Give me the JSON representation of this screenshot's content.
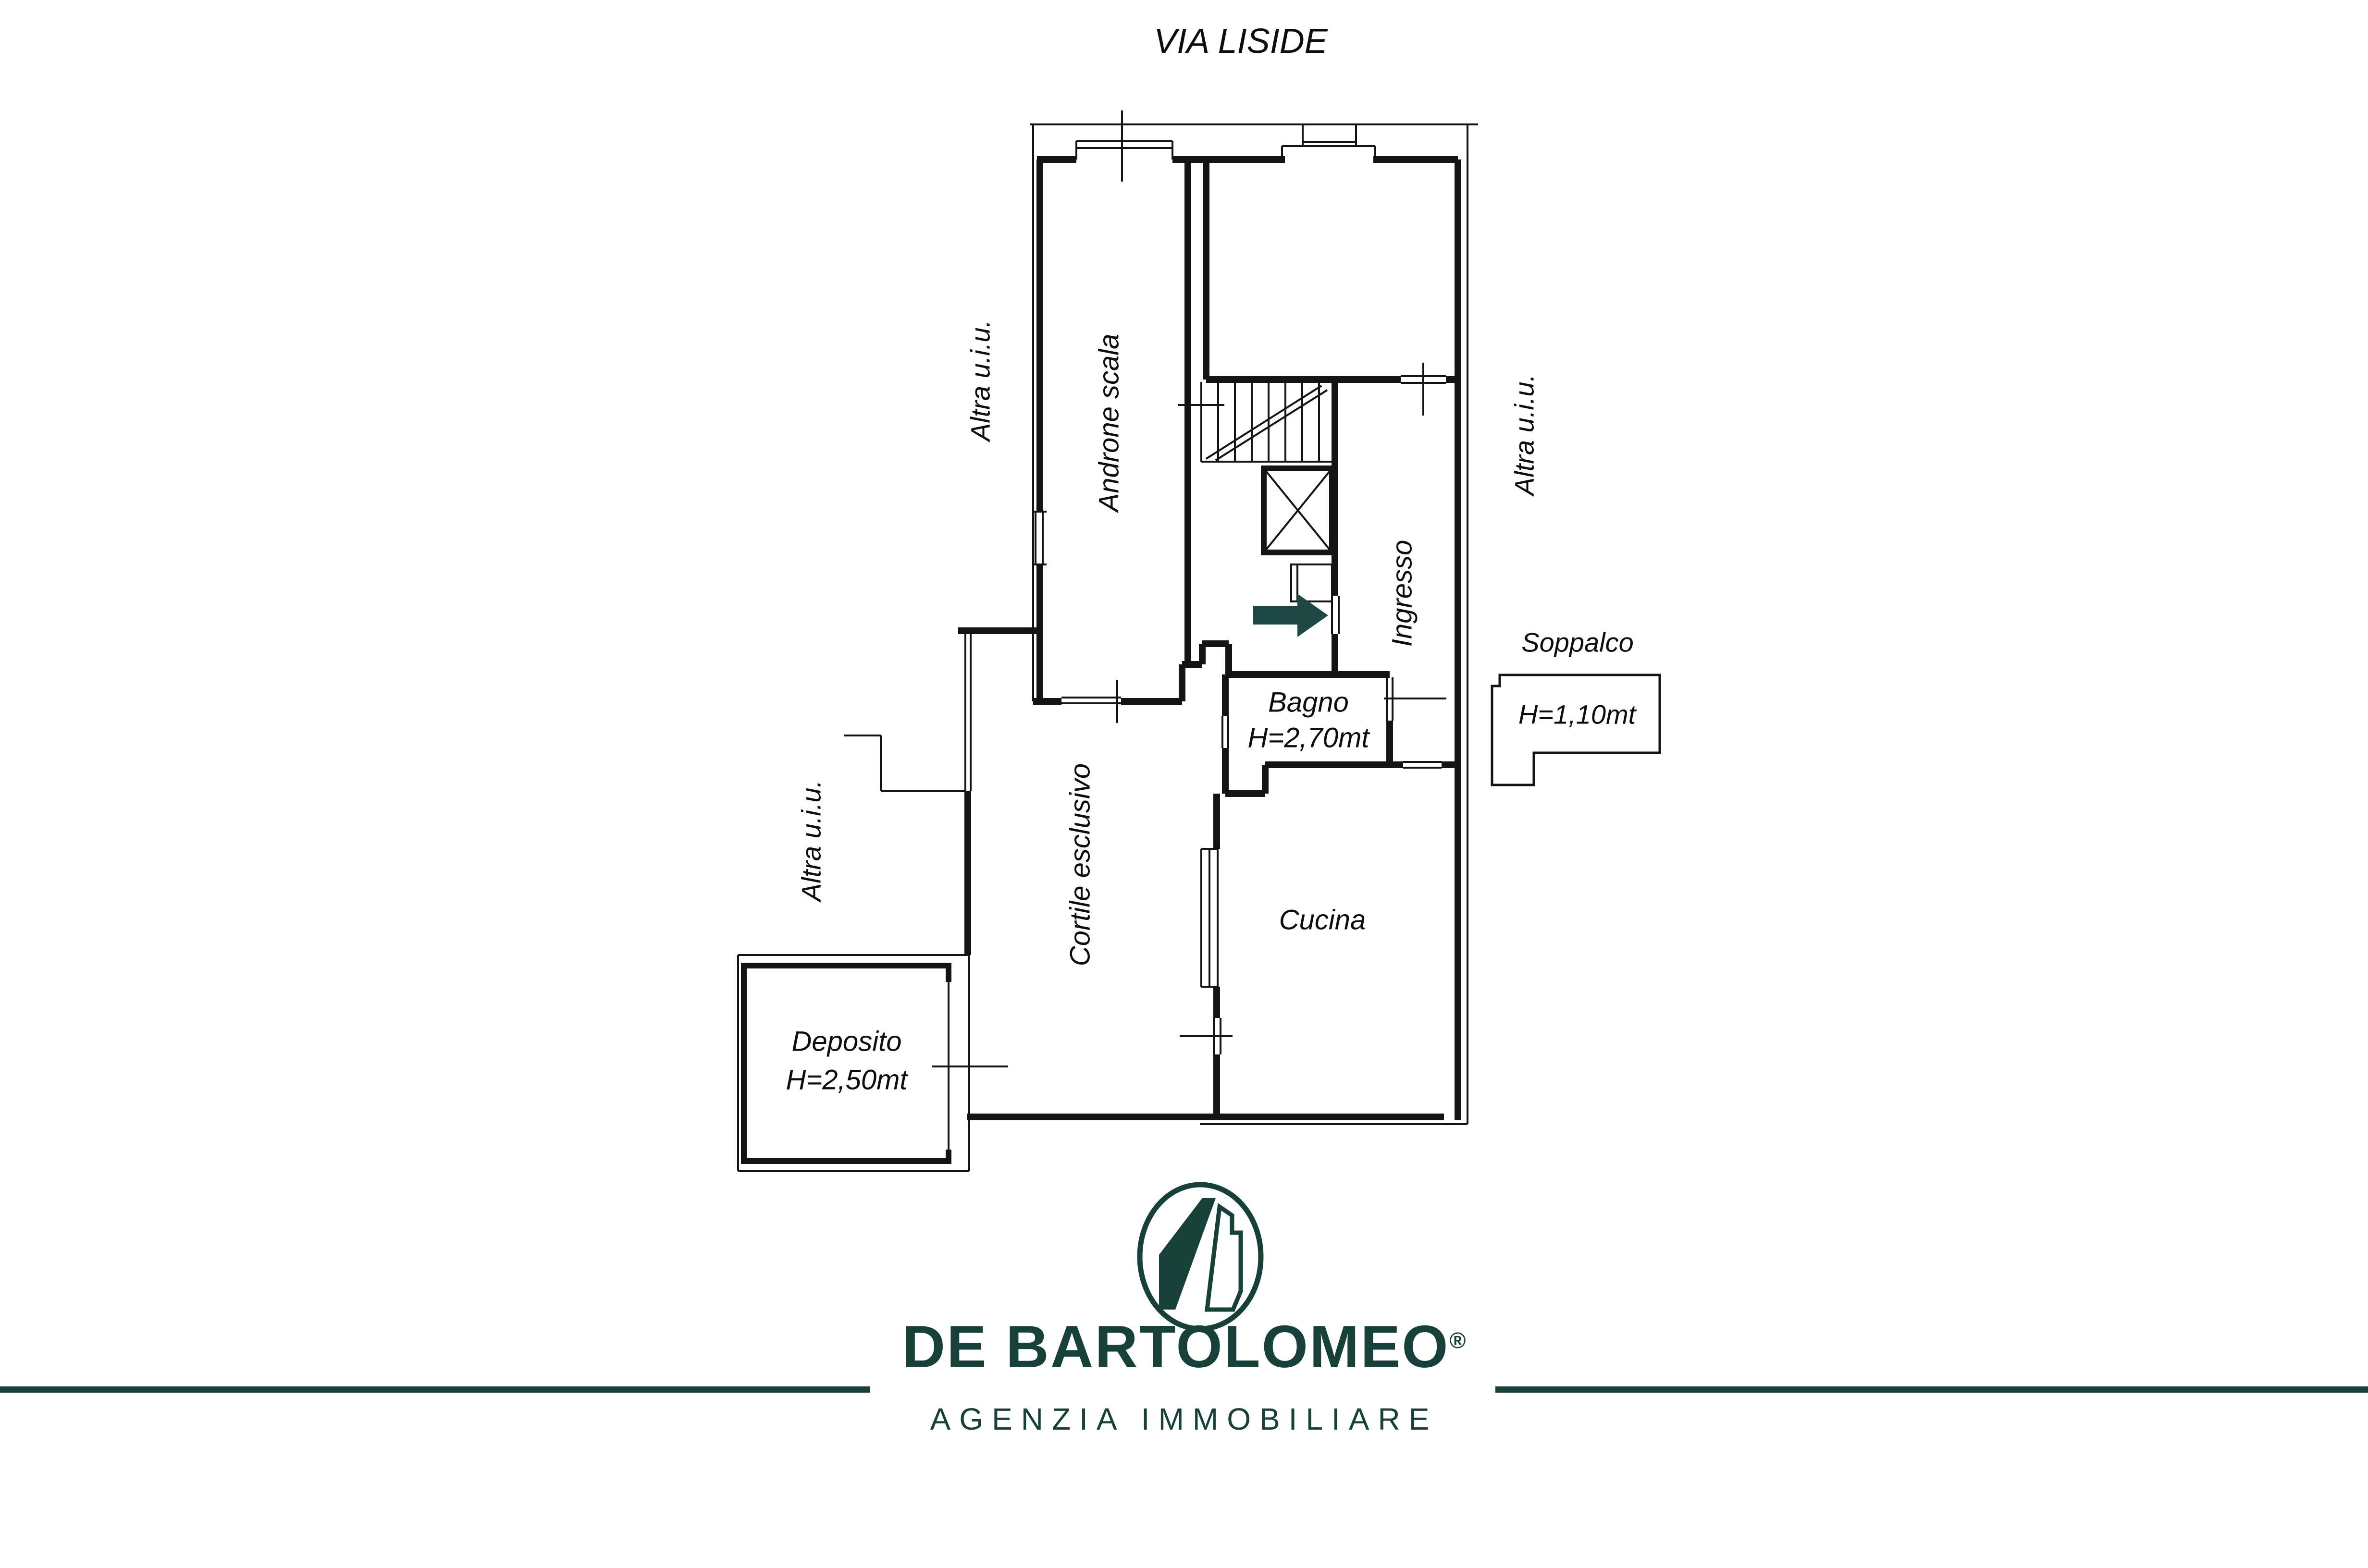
{
  "street": {
    "name": "VIA LISIDE"
  },
  "plan": {
    "rooms": {
      "androne": "Androne scala",
      "ingresso": "Ingresso",
      "bagno": "Bagno",
      "bagno_height": "H=2,70mt",
      "cucina": "Cucina",
      "cortile": "Cortile esclusivo",
      "deposito": "Deposito",
      "deposito_height": "H=2,50mt",
      "soppalco": "Soppalco",
      "soppalco_height": "H=1,10mt"
    },
    "altra_uiu": [
      "Altra u.i.u.",
      "Altra u.i.u.",
      "Altra u.i.u."
    ]
  },
  "footer": {
    "brand": "DE BARTOLOMEO",
    "registered": "®",
    "tagline": "AGENZIA IMMOBILIARE"
  },
  "colors": {
    "brand_green": "#174138",
    "arrow_green": "#1d4843",
    "line_black": "#141414"
  }
}
